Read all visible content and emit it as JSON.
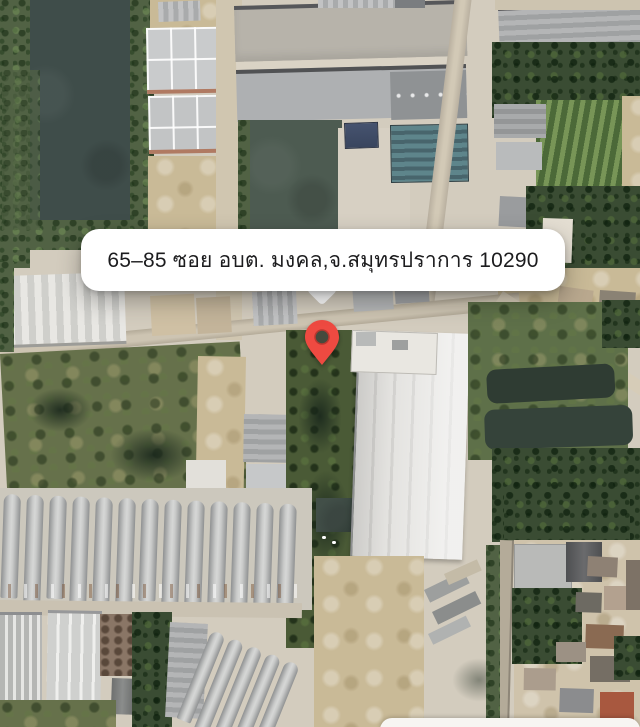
{
  "address_callout": {
    "text": "65–85 ซอย อบต. มงคล,จ.สมุทรปราการ 10290",
    "background": "#ffffff",
    "text_color": "#1c1c1e"
  },
  "pin": {
    "color": "#ee4a41",
    "inner_color": "#454a3d"
  },
  "palette": {
    "water": "#3f4d4a",
    "vegetation": "#516244",
    "trees": "#3a4c33",
    "road": "#c7beac",
    "concrete": "#d7d0c3",
    "dirt": "#c9ba97",
    "roof_gray": "#bcbdbe",
    "roof_teal": "#5e858b",
    "roof_navy": "#46536f",
    "bottom_sheet": "#f7f5f2"
  }
}
